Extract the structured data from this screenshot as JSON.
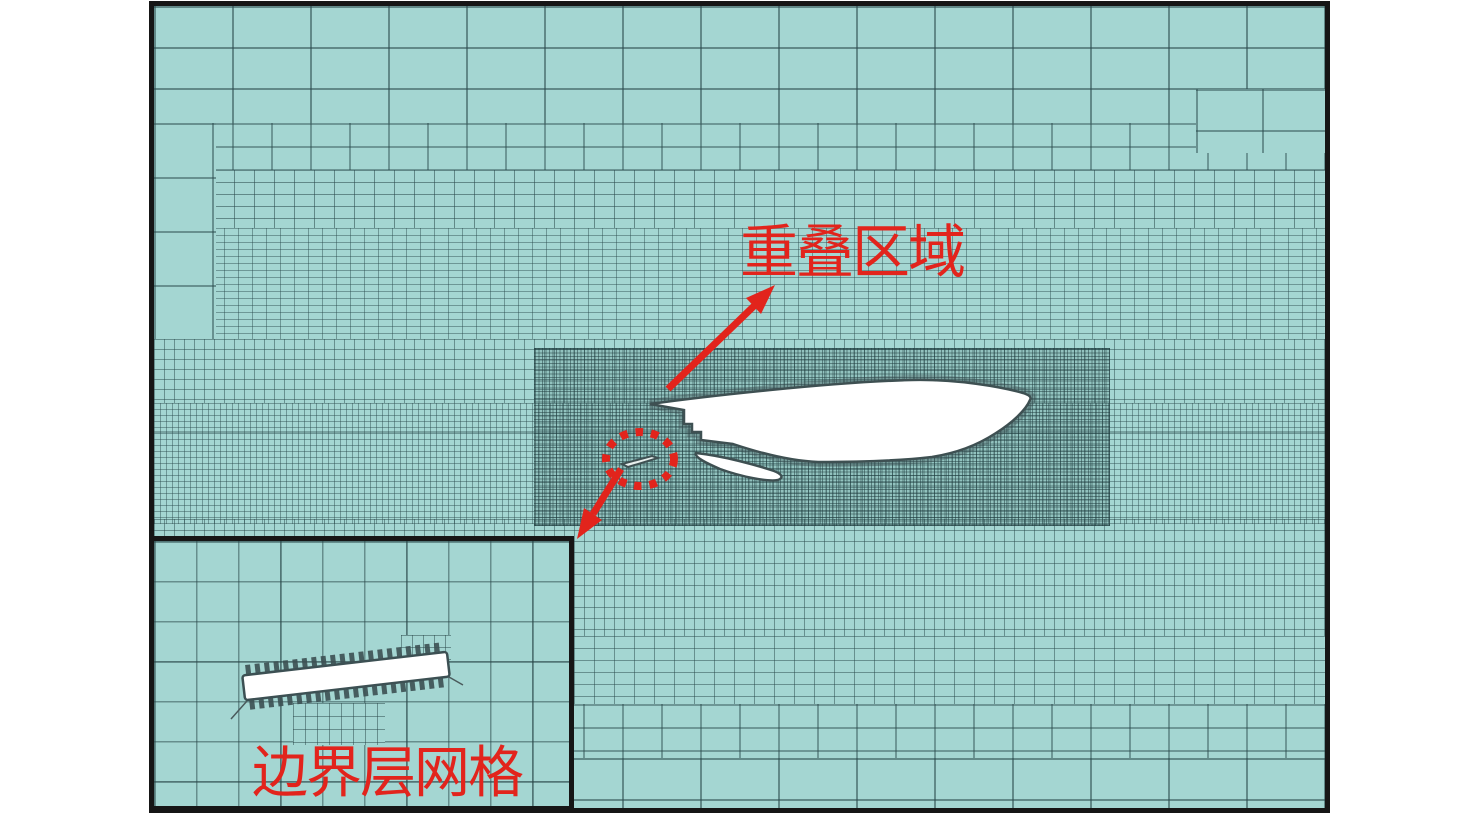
{
  "figure": {
    "labels": {
      "overlap_region": "重叠区域",
      "boundary_layer_mesh": "边界层网格"
    },
    "colors": {
      "mesh_background": "#a4d6d2",
      "mesh_line": "#2a4a4c",
      "annotation_red": "#e2241c",
      "frame_black": "#161616",
      "aircraft_fill": "#ffffff",
      "aircraft_outline": "#3e5052"
    }
  }
}
